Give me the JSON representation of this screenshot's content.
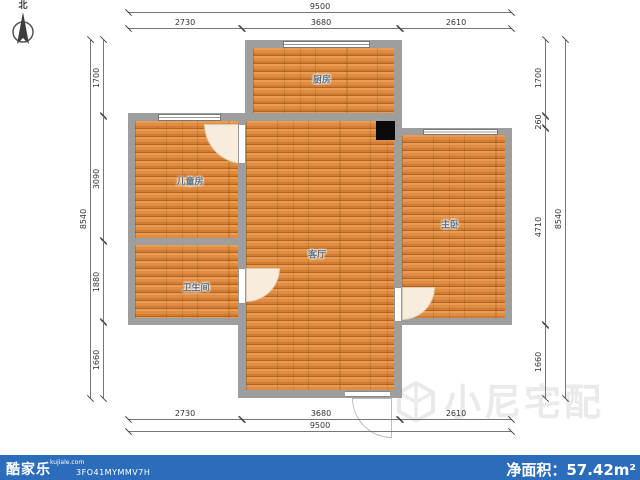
{
  "compass": {
    "label": "北"
  },
  "rooms": [
    {
      "name": "厨房"
    },
    {
      "name": "儿童房"
    },
    {
      "name": "卫生间"
    },
    {
      "name": "客厅"
    },
    {
      "name": "主卧"
    }
  ],
  "dimensions": {
    "top": {
      "total": "9500",
      "segments": [
        "2730",
        "3680",
        "2610"
      ]
    },
    "bottom": {
      "total": "9500",
      "segments": [
        "2730",
        "3680",
        "2610"
      ]
    },
    "left": {
      "total": "8540",
      "segments": [
        "1700",
        "3090",
        "1880",
        "1660"
      ]
    },
    "right": {
      "total": "8540",
      "segments": [
        "1700",
        "260",
        "4710",
        "1660"
      ]
    }
  },
  "watermark": {
    "text": "小尼宅配"
  },
  "footer": {
    "brand": "酷家乐",
    "brand_domain": "kujiale.com",
    "plan_code": "3FO41MYMMV7H",
    "area_label": "净面积：",
    "area_value": "57.42m²",
    "bar_color": "#2b6cbb"
  },
  "colors": {
    "wall_gray": "#9e9e9e",
    "floor_wood": "#e08c42",
    "door_arc_fill": "#f8ecdd",
    "black_column": "#0a0a0a"
  }
}
